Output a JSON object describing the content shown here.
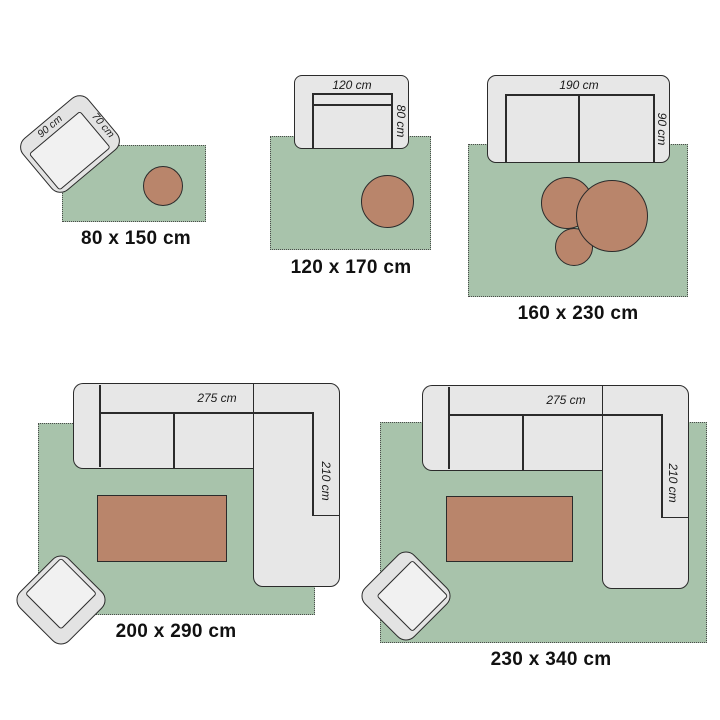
{
  "title": "Rug size guide diagram",
  "colors": {
    "rug": "#a8c3ab",
    "furniture_fill": "#e7e7e7",
    "furniture_seat": "#f1f1f1",
    "wood_table": "#b9856b",
    "outline": "#2b2b2b",
    "text": "#111111",
    "background": "#ffffff"
  },
  "groups": [
    {
      "size_label": "80 x 150 cm",
      "dimensions": {
        "chair_width": "90 cm",
        "chair_depth": "70 cm"
      }
    },
    {
      "size_label": "120 x 170 cm",
      "dimensions": {
        "sofa_width": "120 cm",
        "sofa_depth": "80 cm"
      }
    },
    {
      "size_label": "160 x 230 cm",
      "dimensions": {
        "sofa_width": "190 cm",
        "sofa_depth": "90 cm"
      }
    },
    {
      "size_label": "200 x 290 cm",
      "dimensions": {
        "sofa_width": "275 cm",
        "sofa_depth": "210 cm"
      }
    },
    {
      "size_label": "230 x 340 cm",
      "dimensions": {
        "sofa_width": "275 cm",
        "sofa_depth": "210 cm"
      }
    }
  ]
}
